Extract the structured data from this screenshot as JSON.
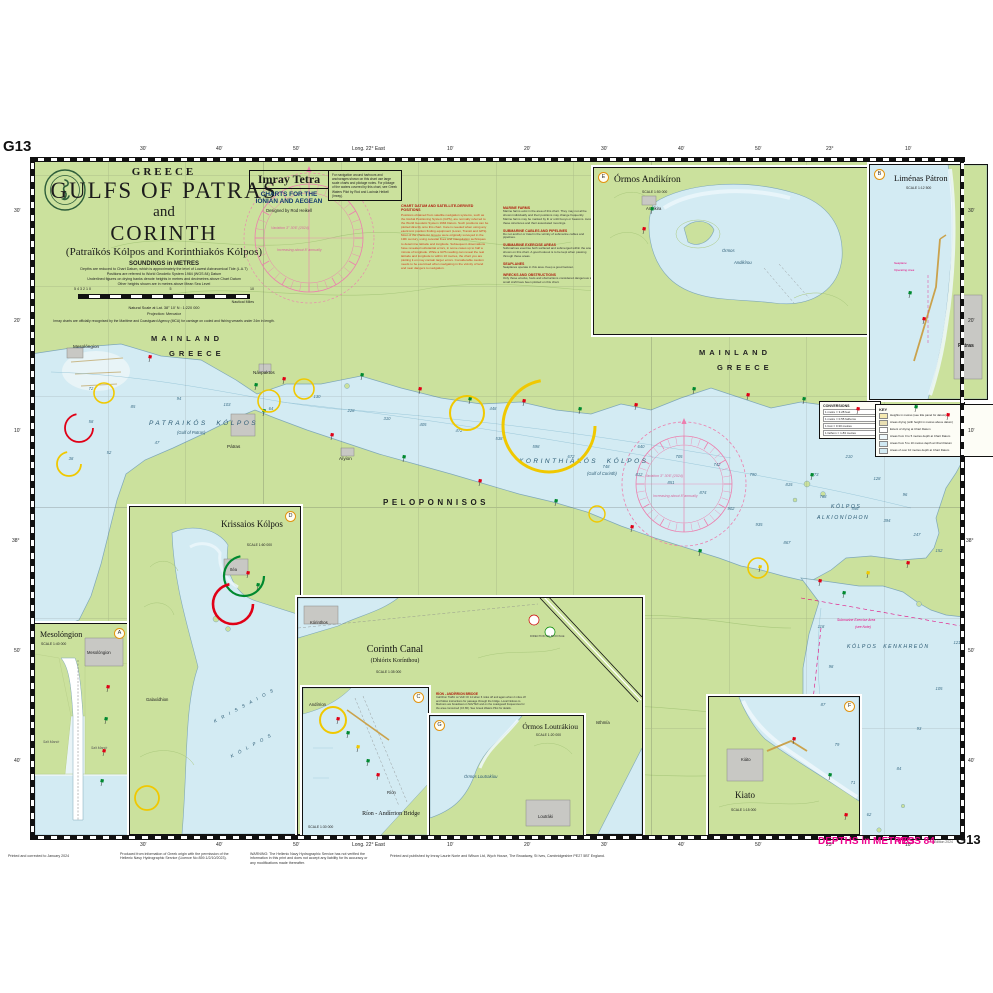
{
  "sheet": {
    "chart_id": "G13",
    "edition": "Edition 2024",
    "depths": "DEPTHS in METRES",
    "datum": "WGS 84"
  },
  "title_block": {
    "country": "GREECE",
    "line1": "GULFS OF PATRAS",
    "line2": "and",
    "line3": "CORINTH",
    "subtitle": "(Patraïkós Kólpos and Korinthiakós Kólpos)",
    "soundings": "SOUNDINGS in METRES",
    "notes": "Depths are reduced to Chart Datum, which is approximately the level of Lowest Astronomical Tide (L.A.T)\nPositions are referred to World Geodetic System 1984 (WGS 84) Datum\nUnderlined figures on drying banks denote heights in metres and decimetres above Chart Datum\nOther heights shown are in metres above Mean Sea Level",
    "scale_left": "5    4    3    2    1    0",
    "scale_mid": "5",
    "scale_right": "10",
    "miles_label": "Nautical Miles",
    "scale_note": "Natural Scale at Lat. 38° 10' N : 1:220 000",
    "projection": "Projection: Mercator",
    "mca": "Imray charts are officially recognised by the Maritime and Coastguard Agency (MCA) for carriage on coded and fishing vessels under 24m in length."
  },
  "imray": {
    "brand": "Imray Tetra",
    "series": "CHARTS FOR THE\nIONIAN AND AEGEAN",
    "designer": "Designed by Rod Heikell"
  },
  "nav_note": "For navigation around harbours and anchorages shown on this chart use large scale charts and pilotage notes. For pilotage of the waters covered by this chart, see Greek Waters Pilot by Rod and Lucinda Heikell (Imray).",
  "datum_note": {
    "title": "CHART DATUM AND SATELLITE-DERIVED POSITIONS",
    "body": "Positions obtained from satellite navigation systems, such as the Global Positioning System (GPS), are normally referred to the World Geodetic System 1984 Datum. Such positions can be plotted directly onto this chart. Care is needed when using any electronic position finding equipment (Loran, Transit and GPS). Most of the charts for Greece were originally surveyed in the 19th century, using celestial fixes and triangulation techniques to determine latitude and longitude. Subsequent observations have revealed substantial errors, in some cases up to half a minute of longitude. While a GPS reading can reveal the real latitude and longitude to within 10 metres, the chart you are plotting it on may contain larger errors. Considerable caution needs to be exercised when navigating in the vicinity of land and near dangers to navigation."
  },
  "side_notes": [
    {
      "h": "MARINE FARMS",
      "b": "Marine farms exist in the area of this chart. They may not all be shown individually and their positions may change frequently. Marine farms may be marked by lit or unlit buoys or beacons. Avoid these structures and their associated moorings."
    },
    {
      "h": "SUBMARINE CABLES AND PIPELINES",
      "b": "Do not anchor or trawl in the vicinity of submarine cables and pipelines."
    },
    {
      "h": "SUBMARINE EXERCISE AREAS",
      "b": "Submarines exercise both surfaced and submerged within the area shown on this chart. A good lookout is to be kept when passing through these areas."
    },
    {
      "h": "SEAPLANES",
      "b": "Seaplanes operate in this area. Keep a good lookout."
    },
    {
      "h": "WRECKS AND OBSTRUCTIONS",
      "b": "Only those wrecks, fouls and obstructions considered dangerous to small craft have been plotted on this chart."
    }
  ],
  "key": {
    "title": "KEY",
    "lines": [
      "Heights in metres (see title panel for datum)",
      "Areas drying (with height in metres above datum)",
      "Extent of drying at Chart Datum",
      "Areas from 0 to 5 metres depth at Chart Datum",
      "Areas from 5 to 10 metres depth at Chart Datum",
      "Areas of over 10 metres depth at Chart Datum"
    ]
  },
  "conversions": {
    "title": "CONVERSIONS",
    "lines": [
      "1 metre = 3.28 feet",
      "1 metre = 0.55 fathoms",
      "1 foot = 0.30 metres",
      "1 fathom = 1.83 metres"
    ]
  },
  "insets": [
    {
      "title": "Mesolóngion",
      "scale": "SCALE 1:40 000",
      "badge": "A",
      "extras": [
        [
          8,
          116,
          "Salt Marsh",
          "it"
        ],
        [
          56,
          122,
          "Salt Marsh",
          "it"
        ],
        [
          52,
          26,
          "Mesolóngion",
          "tn"
        ]
      ]
    },
    {
      "title": "Krissaios Kólpos",
      "scale": "SCALE 1:60 000",
      "badge": "D",
      "extras": [
        [
          100,
          60,
          "Itéa",
          "tn"
        ],
        [
          16,
          190,
          "Galaxídhion",
          "tn"
        ],
        [
          80,
          196,
          "K R I S S A I O S",
          "diag"
        ],
        [
          98,
          236,
          "K Ó L P O S",
          "diag"
        ]
      ]
    },
    {
      "title": "Corinth Canal",
      "subtitle": "(Dhiórix Korínthou)",
      "scale": "SCALE 1:35 000",
      "note_title": "RÍON - ANDÍRRION BRIDGE",
      "note_body": "Call Ríon Traffic on VHF Ch 14 when 6 miles off and again when 2 miles off and follow instructions for passage through the bridge. Local Notices to Mariners are broadcast on NAVTEX and on the coastguard frequencies for the area concerned (Ch 86). See Greek Waters Pilot for details.",
      "extras": [
        [
          12,
          22,
          "Kórinthos",
          "tn"
        ],
        [
          298,
          122,
          "Isthmía",
          "tn"
        ],
        [
          232,
          36,
          "DIRECTION OF BUOYAGE",
          "tinym"
        ]
      ]
    },
    {
      "title": "Ríon - Andírrion Bridge",
      "scale": "SCALE 1:30 000",
      "badge": "C",
      "extras": [
        [
          6,
          14,
          "Andírrion",
          "tn"
        ],
        [
          84,
          102,
          "Ríon",
          "tn"
        ]
      ]
    },
    {
      "title": "Órmos Loutrákiou",
      "scale": "SCALE 1:20 000",
      "badge": "G",
      "extras": [
        [
          34,
          58,
          "Órmos Loutrakíou",
          "seait"
        ],
        [
          108,
          98,
          "Loutráki",
          "tn"
        ]
      ]
    },
    {
      "title": "Kiato",
      "scale": "SCALE 1:15 000",
      "badge": "F",
      "extras": [
        [
          32,
          60,
          "Kiáto",
          "tn"
        ]
      ]
    },
    {
      "title": "Órmos Andikíron",
      "scale": "SCALE 1:50 000",
      "badge": "E",
      "extras": [
        [
          128,
          80,
          "Órmos",
          "seait"
        ],
        [
          140,
          92,
          "Andikírou",
          "seait"
        ],
        [
          52,
          38,
          "Andíkira",
          "tn"
        ]
      ]
    },
    {
      "title": "Liménas Pátron",
      "scale": "SCALE 1:12 500",
      "badge": "B",
      "extras": [
        [
          24,
          96,
          "Seaplane",
          "magv"
        ],
        [
          24,
          103,
          "Operating Area",
          "magv"
        ],
        [
          88,
          178,
          "Pátras",
          "tnb"
        ]
      ]
    }
  ],
  "chart_labels": [
    [
      120,
      176,
      "MAINLAND",
      "lab-landname"
    ],
    [
      138,
      191,
      "GREECE",
      "lab-landname"
    ],
    [
      668,
      190,
      "MAINLAND",
      "lab-landname"
    ],
    [
      686,
      205,
      "GREECE",
      "lab-landname"
    ],
    [
      118,
      262,
      "PATRAIKÓS  KÓLPOS",
      "lab-seaname"
    ],
    [
      146,
      272,
      "(Gulf of Patras)",
      "lab-seasub"
    ],
    [
      488,
      300,
      "KORINTHIAKÓS  KÓLPOS",
      "lab-seaname"
    ],
    [
      556,
      313,
      "(Gulf of Corinth)",
      "lab-seasub"
    ],
    [
      352,
      340,
      "PELOPONNISOS",
      "lab-pen"
    ],
    [
      800,
      346,
      "KÓLPOS",
      "lab-seaname6"
    ],
    [
      786,
      357,
      "ALKIONÍDHON",
      "lab-seaname6"
    ],
    [
      816,
      486,
      "KÓLPOS  KENKHREÓN",
      "lab-seaname6"
    ],
    [
      806,
      460,
      "Submarine Exercise Area",
      "lab-mag"
    ],
    [
      824,
      467,
      "(see Note)",
      "lab-mag"
    ],
    [
      196,
      286,
      "Pátras",
      "lab-town"
    ],
    [
      222,
      212,
      "Návpaktos",
      "lab-town"
    ],
    [
      308,
      298,
      "Aíyion",
      "lab-town"
    ],
    [
      42,
      186,
      "Mesolóngion",
      "lab-town"
    ],
    [
      240,
      68,
      "Variation 3° 30'E (2024)",
      "lab-rose"
    ],
    [
      246,
      90,
      "Increasing about 8' annually",
      "lab-rose"
    ],
    [
      614,
      316,
      "Variation 3° 30'E (2024)",
      "lab-rose"
    ],
    [
      622,
      336,
      "Increasing about 8' annually",
      "lab-rose"
    ]
  ],
  "margin_labels": [
    [
      140,
      146,
      "30'",
      "m-tick"
    ],
    [
      216,
      146,
      "40'",
      "m-tick"
    ],
    [
      293,
      146,
      "50'",
      "m-tick"
    ],
    [
      352,
      146,
      "Long. 22° East",
      "m-tick"
    ],
    [
      447,
      146,
      "10'",
      "m-tick"
    ],
    [
      524,
      146,
      "20'",
      "m-tick"
    ],
    [
      601,
      146,
      "30'",
      "m-tick"
    ],
    [
      678,
      146,
      "40'",
      "m-tick"
    ],
    [
      755,
      146,
      "50'",
      "m-tick"
    ],
    [
      826,
      146,
      "23°",
      "m-tick"
    ],
    [
      905,
      146,
      "10'",
      "m-tick"
    ],
    [
      140,
      842,
      "30'",
      "m-tick"
    ],
    [
      216,
      842,
      "40'",
      "m-tick"
    ],
    [
      293,
      842,
      "50'",
      "m-tick"
    ],
    [
      352,
      842,
      "Long. 22° East",
      "m-tick"
    ],
    [
      447,
      842,
      "10'",
      "m-tick"
    ],
    [
      524,
      842,
      "20'",
      "m-tick"
    ],
    [
      601,
      842,
      "30'",
      "m-tick"
    ],
    [
      678,
      842,
      "40'",
      "m-tick"
    ],
    [
      755,
      842,
      "50'",
      "m-tick"
    ],
    [
      826,
      842,
      "23°",
      "m-tick"
    ],
    [
      905,
      842,
      "10'",
      "m-tick"
    ],
    [
      14,
      208,
      "30'",
      "m-tick"
    ],
    [
      14,
      318,
      "20'",
      "m-tick"
    ],
    [
      14,
      428,
      "10'",
      "m-tick"
    ],
    [
      12,
      538,
      "38°",
      "m-tick"
    ],
    [
      14,
      648,
      "50'",
      "m-tick"
    ],
    [
      14,
      758,
      "40'",
      "m-tick"
    ],
    [
      968,
      208,
      "30'",
      "m-tick"
    ],
    [
      968,
      318,
      "20'",
      "m-tick"
    ],
    [
      968,
      428,
      "10'",
      "m-tick"
    ],
    [
      966,
      538,
      "38°",
      "m-tick"
    ],
    [
      968,
      648,
      "50'",
      "m-tick"
    ],
    [
      968,
      758,
      "40'",
      "m-tick"
    ],
    [
      3,
      138,
      "G13",
      "m-gidtop"
    ],
    [
      8,
      854,
      "Printed and corrected to January 2024",
      "m-foot",
      110
    ],
    [
      120,
      852,
      "Produced from information of Greek origin with the permission of the Hellenic Navy Hydrographic Service (Licence No 859.1/2/10/2023).",
      "m-foot",
      118
    ],
    [
      250,
      852,
      "WARNING: The Hellenic Navy Hydrographic Service has not verified the information in this print and does not accept any liability for its accuracy or any modifications made thereafter.",
      "m-foot",
      120
    ],
    [
      390,
      854,
      "Printed and published by Imray Laurie Norie and Wilson Ltd, Wych House, The Broadway, St Ives, Cambridgeshire PE27 5BT England.",
      "m-foot",
      330
    ],
    [
      818,
      836,
      "DEPTHS in METRES",
      "m-mag"
    ],
    [
      897,
      836,
      "WGS 84",
      "m-mag"
    ],
    [
      934,
      840,
      "Edition 2024",
      "m-tiny"
    ],
    [
      956,
      832,
      "G13",
      "m-gid"
    ]
  ],
  "symbols": {
    "soundings": [
      [
        60,
        232,
        "72"
      ],
      [
        102,
        250,
        "85"
      ],
      [
        148,
        242,
        "94"
      ],
      [
        196,
        248,
        "103"
      ],
      [
        240,
        252,
        "64"
      ],
      [
        286,
        240,
        "130"
      ],
      [
        320,
        254,
        "228"
      ],
      [
        356,
        262,
        "310"
      ],
      [
        392,
        268,
        "405"
      ],
      [
        428,
        274,
        "472"
      ],
      [
        462,
        252,
        "448"
      ],
      [
        468,
        282,
        "538"
      ],
      [
        505,
        290,
        "598"
      ],
      [
        540,
        300,
        "672"
      ],
      [
        575,
        310,
        "748"
      ],
      [
        608,
        318,
        "812"
      ],
      [
        640,
        326,
        "851"
      ],
      [
        672,
        336,
        "874"
      ],
      [
        700,
        352,
        "902"
      ],
      [
        728,
        368,
        "935"
      ],
      [
        756,
        386,
        "867"
      ],
      [
        610,
        290,
        "640"
      ],
      [
        648,
        300,
        "705"
      ],
      [
        686,
        308,
        "742"
      ],
      [
        722,
        318,
        "790"
      ],
      [
        758,
        328,
        "815"
      ],
      [
        792,
        340,
        "788"
      ],
      [
        824,
        352,
        "556"
      ],
      [
        856,
        364,
        "394"
      ],
      [
        886,
        378,
        "247"
      ],
      [
        908,
        394,
        "152"
      ],
      [
        818,
        300,
        "210"
      ],
      [
        784,
        318,
        "173"
      ],
      [
        846,
        322,
        "128"
      ],
      [
        874,
        338,
        "96"
      ],
      [
        790,
        470,
        "118"
      ],
      [
        800,
        510,
        "98"
      ],
      [
        792,
        548,
        "87"
      ],
      [
        806,
        588,
        "79"
      ],
      [
        822,
        626,
        "71"
      ],
      [
        838,
        658,
        "62"
      ],
      [
        868,
        612,
        "84"
      ],
      [
        888,
        572,
        "93"
      ],
      [
        908,
        532,
        "105"
      ],
      [
        926,
        486,
        "121"
      ],
      [
        40,
        302,
        "38"
      ],
      [
        78,
        296,
        "52"
      ],
      [
        126,
        286,
        "47"
      ],
      [
        60,
        265,
        "58"
      ]
    ],
    "buoys": [
      [
        118,
        204,
        "r"
      ],
      [
        224,
        232,
        "g"
      ],
      [
        252,
        226,
        "r"
      ],
      [
        330,
        222,
        "g"
      ],
      [
        388,
        236,
        "r"
      ],
      [
        438,
        246,
        "g"
      ],
      [
        492,
        248,
        "r"
      ],
      [
        548,
        256,
        "g"
      ],
      [
        604,
        252,
        "r"
      ],
      [
        662,
        236,
        "g"
      ],
      [
        716,
        242,
        "r"
      ],
      [
        772,
        246,
        "g"
      ],
      [
        826,
        256,
        "r"
      ],
      [
        884,
        254,
        "g"
      ],
      [
        916,
        262,
        "r"
      ],
      [
        232,
        258,
        "g"
      ],
      [
        300,
        282,
        "r"
      ],
      [
        372,
        304,
        "g"
      ],
      [
        448,
        328,
        "r"
      ],
      [
        524,
        348,
        "g"
      ],
      [
        600,
        374,
        "r"
      ],
      [
        668,
        398,
        "g"
      ],
      [
        728,
        414,
        "y"
      ],
      [
        788,
        428,
        "r"
      ],
      [
        812,
        440,
        "g"
      ],
      [
        798,
        622,
        "g"
      ],
      [
        814,
        662,
        "r"
      ],
      [
        836,
        420,
        "y"
      ],
      [
        876,
        410,
        "r"
      ],
      [
        780,
        322,
        "g"
      ],
      [
        76,
        534,
        "r"
      ],
      [
        74,
        566,
        "g"
      ],
      [
        72,
        598,
        "r"
      ],
      [
        70,
        628,
        "g"
      ],
      [
        306,
        566,
        "r"
      ],
      [
        316,
        580,
        "g"
      ],
      [
        326,
        594,
        "y"
      ],
      [
        336,
        608,
        "g"
      ],
      [
        346,
        622,
        "r"
      ],
      [
        216,
        420,
        "r"
      ],
      [
        226,
        432,
        "g"
      ],
      [
        878,
        140,
        "g"
      ],
      [
        892,
        166,
        "r"
      ],
      [
        620,
        56,
        "g"
      ],
      [
        612,
        76,
        "r"
      ],
      [
        762,
        586,
        "r"
      ]
    ],
    "circles": [
      [
        73,
        235,
        10,
        "#f0c800",
        1.6,
        0
      ],
      [
        38,
        306,
        12,
        "#f0c800",
        1.8,
        1
      ],
      [
        238,
        243,
        11,
        "#f0c800",
        1.6,
        0
      ],
      [
        273,
        231,
        10,
        "#f0c800",
        1.6,
        0
      ],
      [
        436,
        255,
        17,
        "#f0c800",
        2,
        0
      ],
      [
        518,
        268,
        46,
        "#f0c800",
        3,
        1
      ],
      [
        566,
        356,
        8,
        "#f0c800",
        1.4,
        0
      ],
      [
        727,
        410,
        10,
        "#f0c800",
        1.6,
        0
      ],
      [
        116,
        640,
        12,
        "#f0c800",
        1.8,
        0
      ],
      [
        302,
        562,
        13,
        "#f0c800",
        2,
        0
      ],
      [
        48,
        270,
        14,
        "#e00016",
        1.8,
        1
      ],
      [
        213,
        418,
        20,
        "#00892f",
        2.2,
        1
      ],
      [
        202,
        446,
        20,
        "#e00016",
        2.6,
        1
      ],
      [
        653,
        326,
        62,
        "#ec7fae",
        0.8,
        2
      ]
    ],
    "roses": [
      {
        "cx": 278,
        "cy": 80,
        "r": 54,
        "dash": 1
      },
      {
        "cx": 653,
        "cy": 326,
        "r": 48,
        "dash": 0
      }
    ]
  }
}
